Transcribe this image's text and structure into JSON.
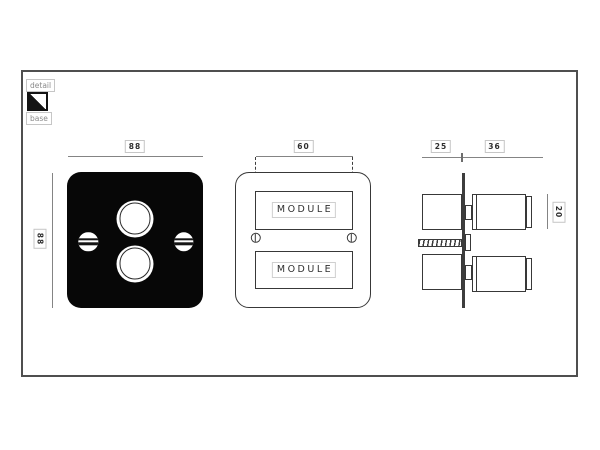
{
  "legend": {
    "detail_label": "detail",
    "base_label": "base"
  },
  "front_view": {
    "width_dim": "88",
    "height_dim": "88"
  },
  "module_view": {
    "width_dim": "60",
    "top_module_label": "MODULE",
    "bottom_module_label": "MODULE"
  },
  "side_view": {
    "box_depth_dim": "25",
    "knob_depth_dim": "36",
    "knob_height_dim": "20"
  },
  "colors": {
    "plate_black": "#070707",
    "outline_dark": "#383838",
    "dim_line_gray": "#848484",
    "label_border_gray": "#c6c6c6",
    "label_text": "#2e2e2e",
    "legend_text": "#8a8a8a",
    "frame_border": "#4f4f4f"
  }
}
